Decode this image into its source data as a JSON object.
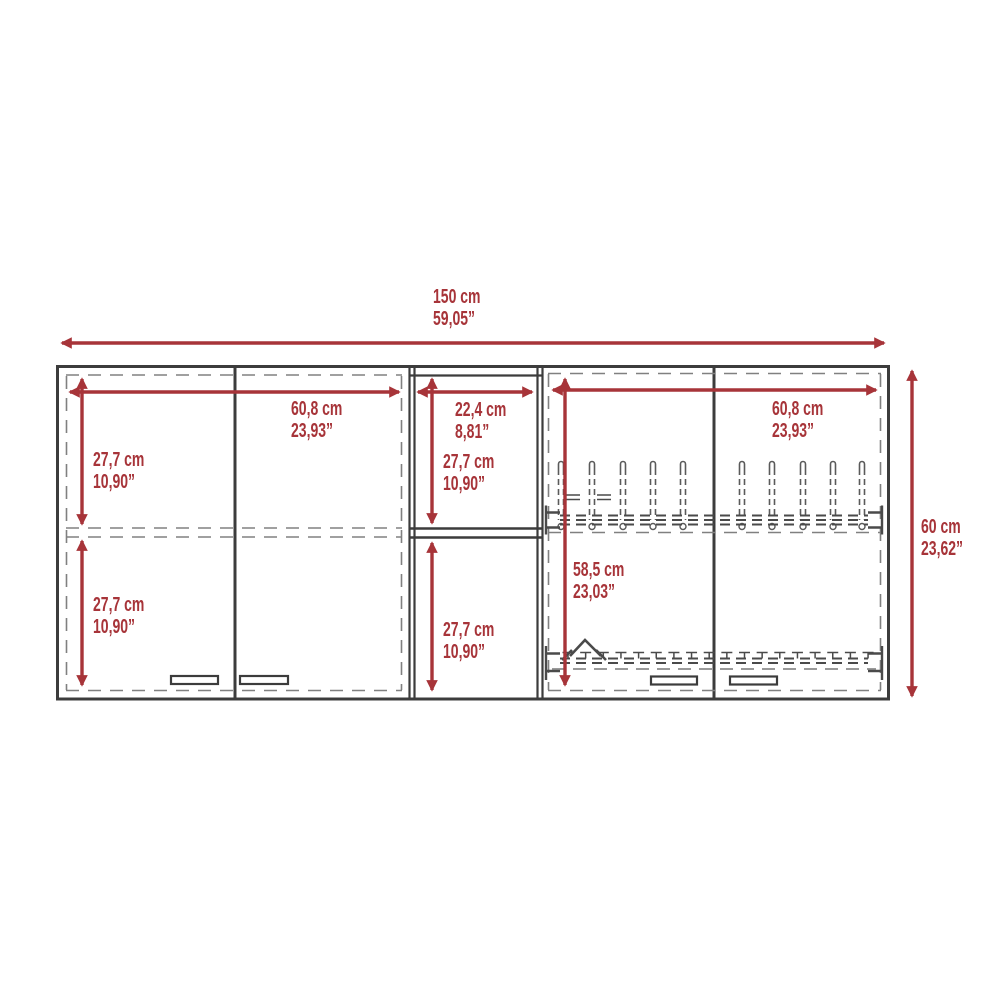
{
  "colors": {
    "dimension_red": "#A73439",
    "line_dark": "#3C3C3C",
    "line_dash": "#808080"
  },
  "dimensions": {
    "overall_width": {
      "cm": "150 cm",
      "inch": "59,05”"
    },
    "overall_height": {
      "cm": "60 cm",
      "inch": "23,62”"
    },
    "left_section_width": {
      "cm": "60,8 cm",
      "inch": "23,93”"
    },
    "middle_section_width": {
      "cm": "22,4 cm",
      "inch": "8,81”"
    },
    "right_section_width": {
      "cm": "60,8 cm",
      "inch": "23,93”"
    },
    "left_upper_height": {
      "cm": "27,7 cm",
      "inch": "10,90”"
    },
    "left_lower_height": {
      "cm": "27,7 cm",
      "inch": "10,90”"
    },
    "middle_upper_height": {
      "cm": "27,7 cm",
      "inch": "10,90”"
    },
    "middle_lower_height": {
      "cm": "27,7 cm",
      "inch": "10,90”"
    },
    "right_section_height": {
      "cm": "58,5 cm",
      "inch": "23,03”"
    }
  }
}
